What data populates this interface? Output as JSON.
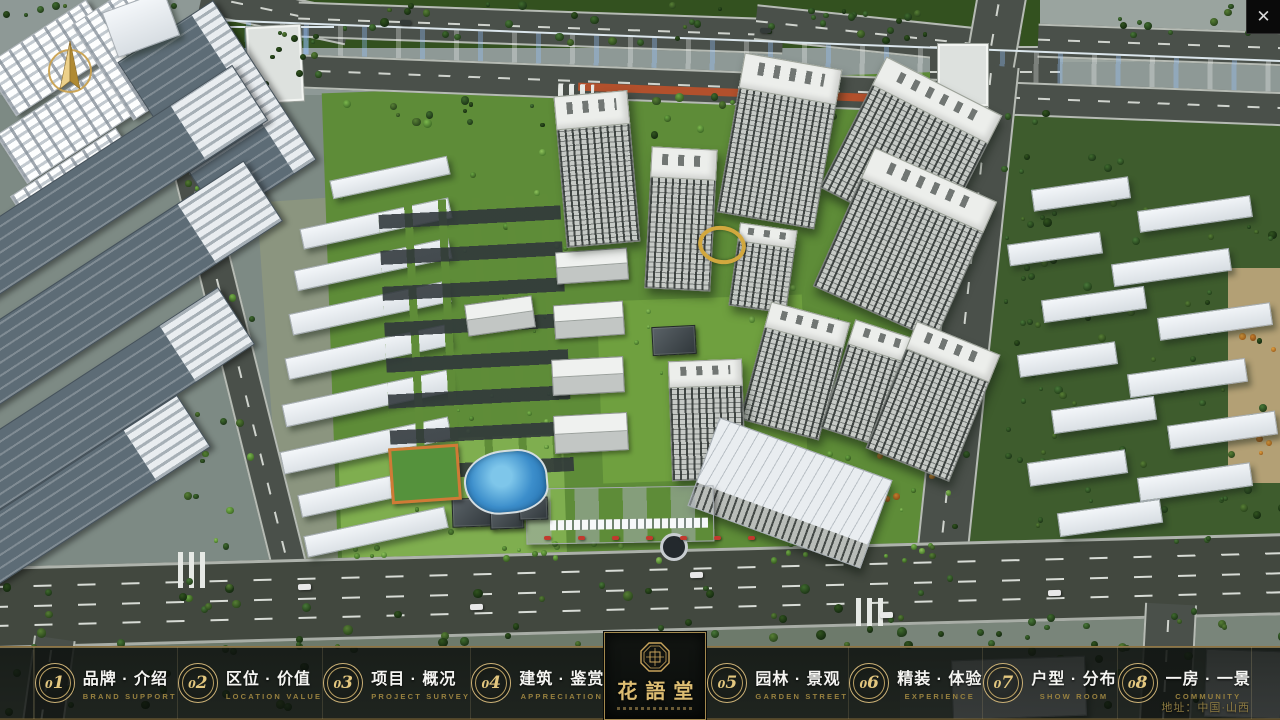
{
  "window": {
    "close_glyph": "✕"
  },
  "logo": {
    "title": "花語堂"
  },
  "navbar": {
    "items": [
      {
        "num": "01",
        "zh": "品牌 · 介绍",
        "en": "BRAND SUPPORT"
      },
      {
        "num": "02",
        "zh": "区位 · 价值",
        "en": "LOCATION VALUE"
      },
      {
        "num": "03",
        "zh": "项目 · 概况",
        "en": "PROJECT SURVEY"
      },
      {
        "num": "04",
        "zh": "建筑 · 鉴赏",
        "en": "APPRECIATION"
      },
      {
        "num": "05",
        "zh": "园林 · 景观",
        "en": "GARDEN STREET"
      },
      {
        "num": "06",
        "zh": "精装 · 体验",
        "en": "EXPERIENCE"
      },
      {
        "num": "07",
        "zh": "户型 · 分布",
        "en": "SHOW ROOM"
      },
      {
        "num": "08",
        "zh": "一房 · 一景",
        "en": "COMMUNITY"
      }
    ]
  },
  "footer": {
    "address": "地址：中国·山西"
  },
  "colors": {
    "accent_gold": "#c9a96a",
    "gold_text": "#97803f",
    "bar_border_gold": "#8f7443",
    "river_blue": "#2a63b8",
    "site_green": "#5e8c38"
  }
}
